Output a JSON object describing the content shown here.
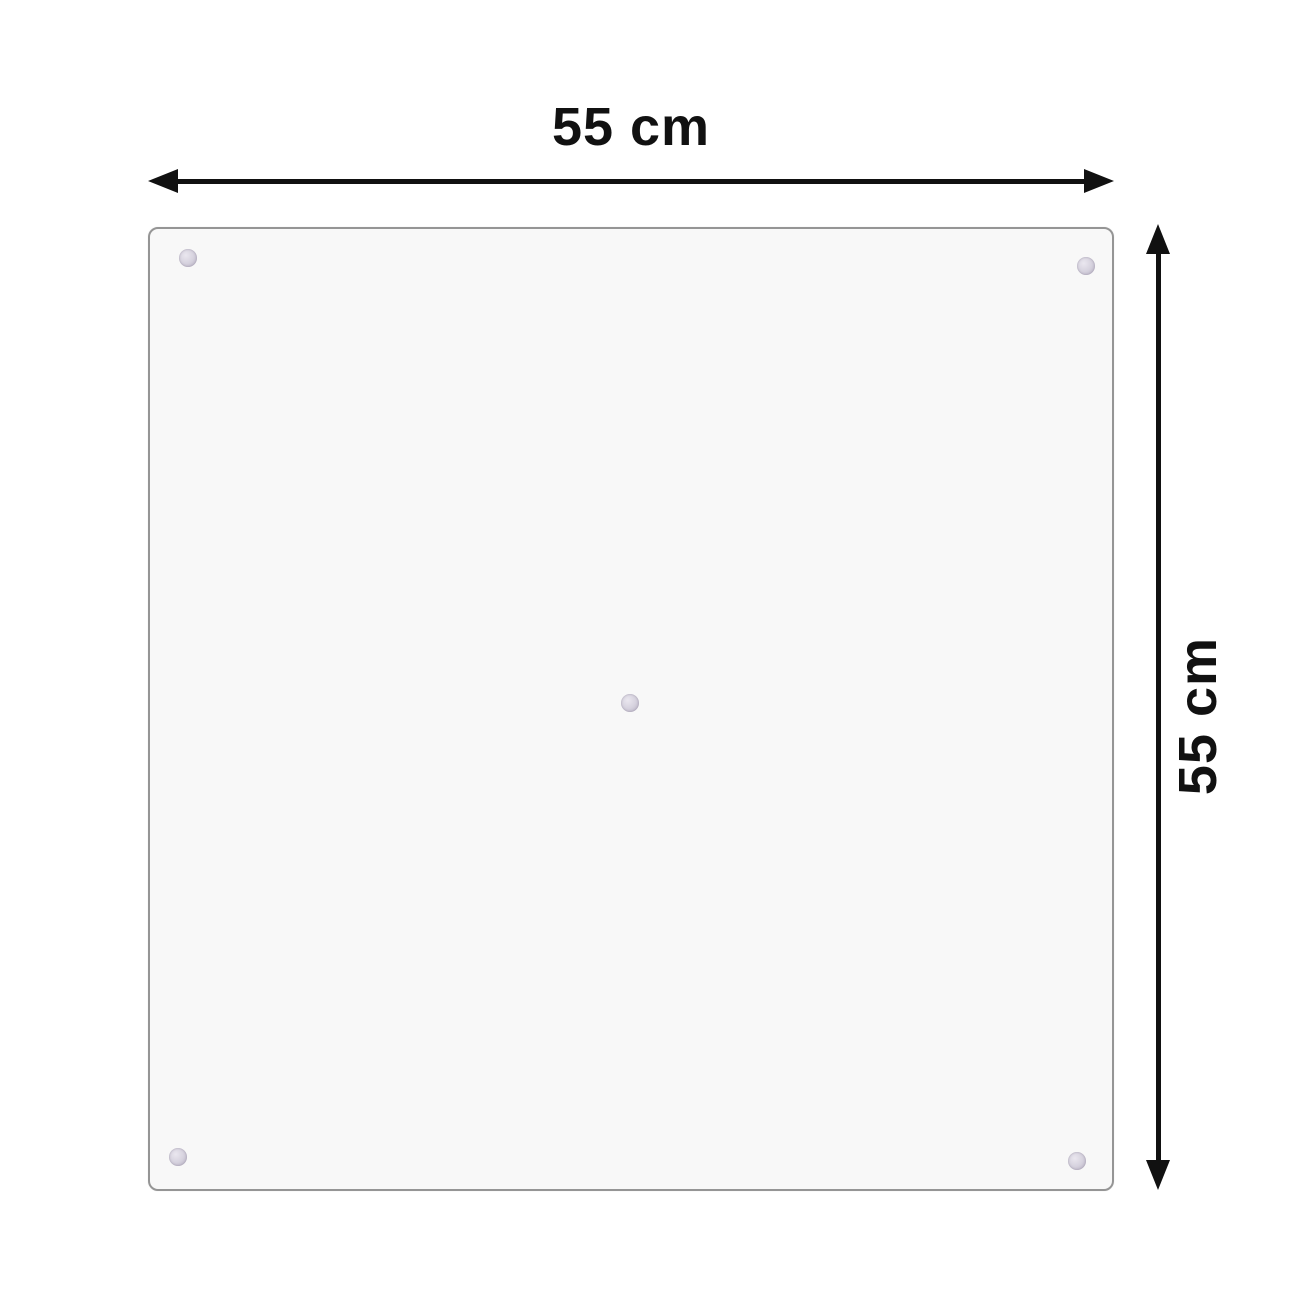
{
  "diagram": {
    "width_label": "55 cm",
    "height_label": "55 cm",
    "panel": {
      "suction_cup_count": 5,
      "suction_cups": [
        {
          "x": 188,
          "y": 258
        },
        {
          "x": 1086,
          "y": 266
        },
        {
          "x": 630,
          "y": 703
        },
        {
          "x": 178,
          "y": 1157
        },
        {
          "x": 1077,
          "y": 1161
        }
      ]
    },
    "colors": {
      "background": "#ffffff",
      "arrow": "#111111",
      "panel_fill": "#f8f8f8",
      "panel_border": "#959595",
      "suction_cup": "#c7c2cf"
    }
  }
}
